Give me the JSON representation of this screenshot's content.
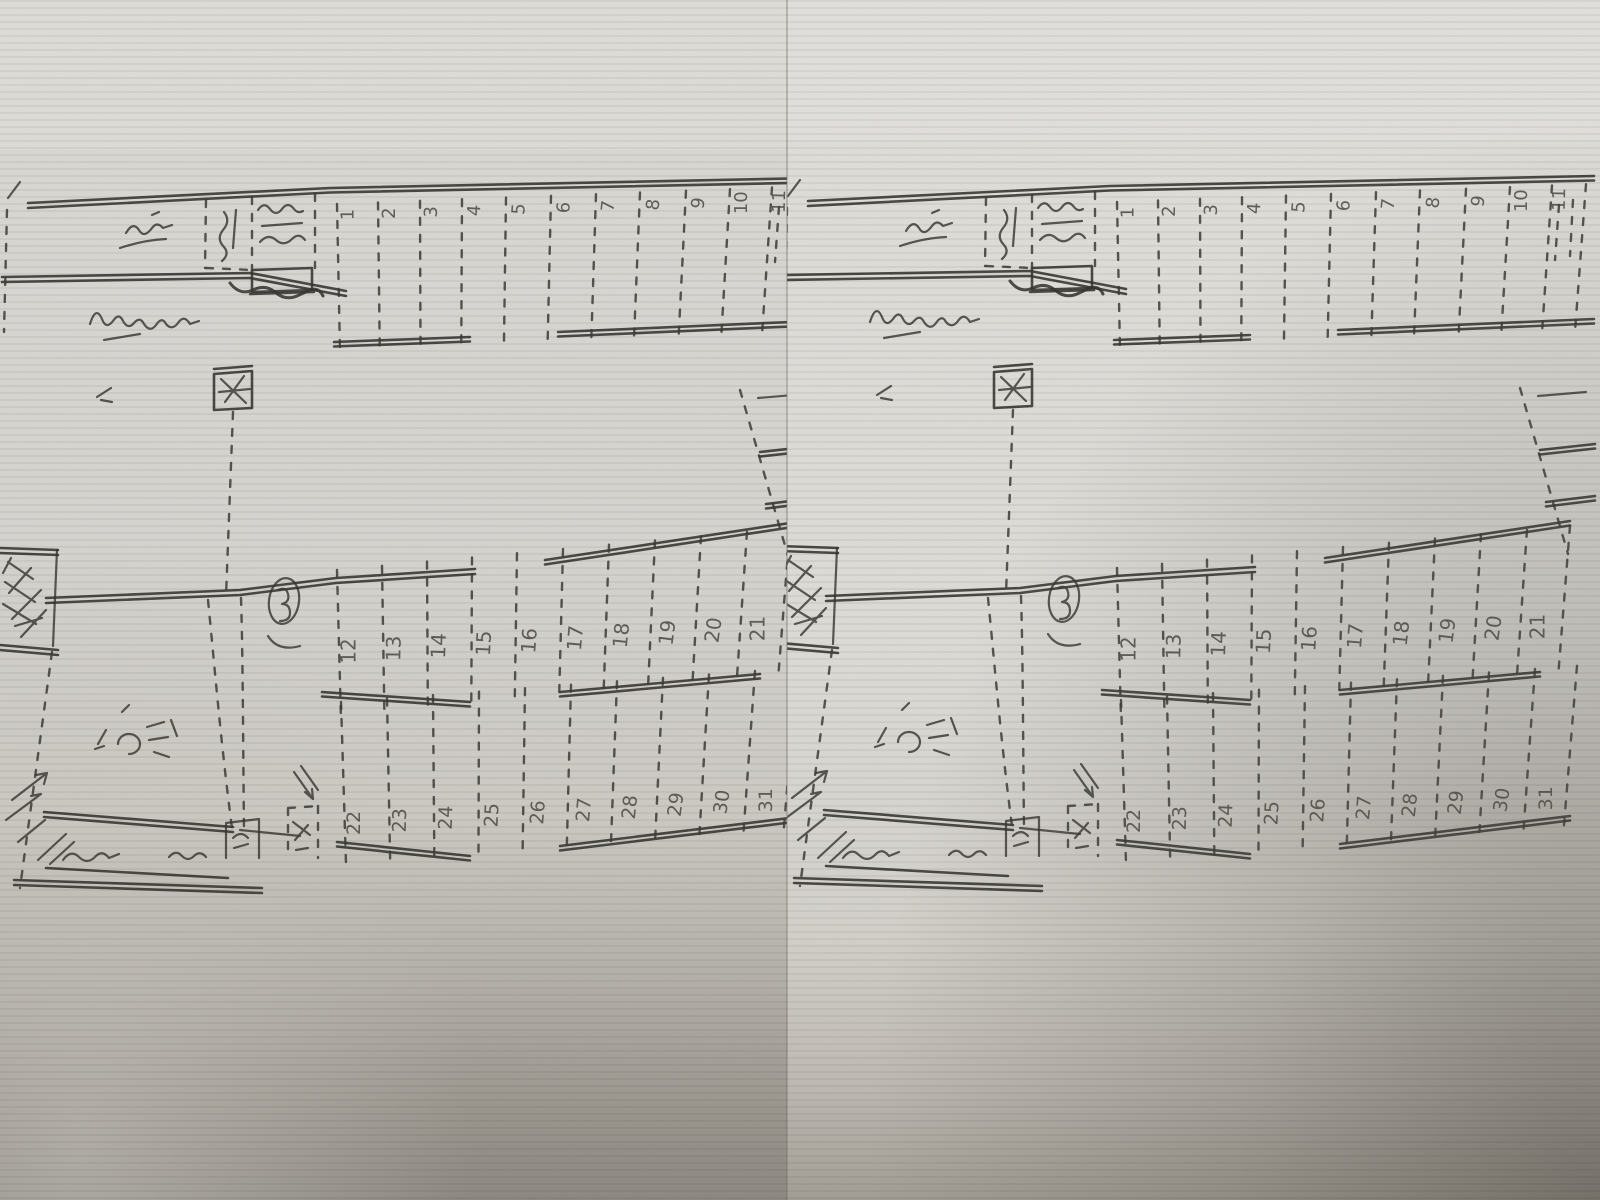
{
  "alt": "Photograph of a photocopied hand-drawn site plan with numbered parking stalls, shown as two side-by-side photo panels of the same sheet",
  "colors": {
    "paper": "#d8d6d1",
    "paper_light": "#dfddd8",
    "ink": "#33312c",
    "pencil": "#45423c",
    "shadow_dark": "#84807a"
  },
  "panels": [
    {
      "id": "left-photo"
    },
    {
      "id": "right-photo"
    }
  ],
  "plan": {
    "stall_rows": [
      {
        "id": "top",
        "numbers": [
          "1",
          "2",
          "3",
          "4",
          "5",
          "6",
          "7",
          "8",
          "9",
          "10",
          "11"
        ]
      },
      {
        "id": "middle",
        "numbers": [
          "12",
          "13",
          "14",
          "15",
          "16",
          "17",
          "18",
          "19",
          "20",
          "21"
        ]
      },
      {
        "id": "bottom",
        "numbers": [
          "22",
          "23",
          "24",
          "25",
          "26",
          "27",
          "28",
          "29",
          "30",
          "31"
        ]
      }
    ],
    "handwritten_notes": [
      {
        "id": "top-left-title",
        "legible": false
      },
      {
        "id": "dashed-box-note",
        "legible": false
      },
      {
        "id": "office-box-note",
        "legible": false
      },
      {
        "id": "under-box-note",
        "legible": false
      },
      {
        "id": "road-label",
        "legible": false
      },
      {
        "id": "crossed-box",
        "legible": false
      },
      {
        "id": "circled-road-mark",
        "legible": false
      },
      {
        "id": "left-area-note",
        "legible": false
      },
      {
        "id": "bottom-left-label-1",
        "legible": false
      },
      {
        "id": "bottom-left-label-2",
        "legible": false
      }
    ]
  }
}
